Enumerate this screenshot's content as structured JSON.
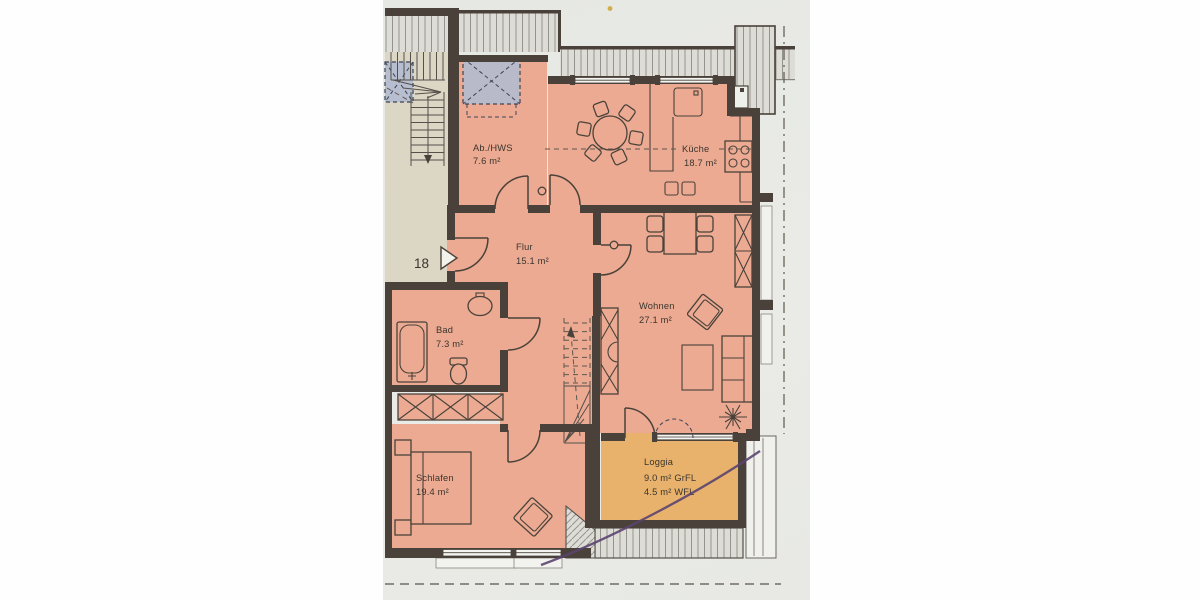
{
  "plan": {
    "title": "apartment-floor-plan",
    "entrance": {
      "unit_number": "18"
    },
    "rooms": [
      {
        "key": "ab-hws",
        "name": "Ab./HWS",
        "area": "7.6 m²"
      },
      {
        "key": "kueche",
        "name": "Küche",
        "area": "18.7 m²"
      },
      {
        "key": "flur",
        "name": "Flur",
        "area": "15.1 m²"
      },
      {
        "key": "wohnen",
        "name": "Wohnen",
        "area": "27.1 m²"
      },
      {
        "key": "bad",
        "name": "Bad",
        "area": "7.3 m²"
      },
      {
        "key": "schlafen",
        "name": "Schlafen",
        "area": "19.4 m²"
      },
      {
        "key": "loggia",
        "name": "Loggia",
        "area_grfl": "9.0 m²  GrFL",
        "area_wfl": "4.5 m²  WFL"
      }
    ],
    "colors": {
      "room_fill": "#ecaa92",
      "loggia_fill": "#e9b26c",
      "wall": "#4a423a",
      "stairwell_fill": "#dcd6c5",
      "skylight_fill": "#b3bccf",
      "photo_background": "#e8eae5",
      "hatch_line": "#95948c",
      "pen_mark": "#5b4470"
    }
  }
}
